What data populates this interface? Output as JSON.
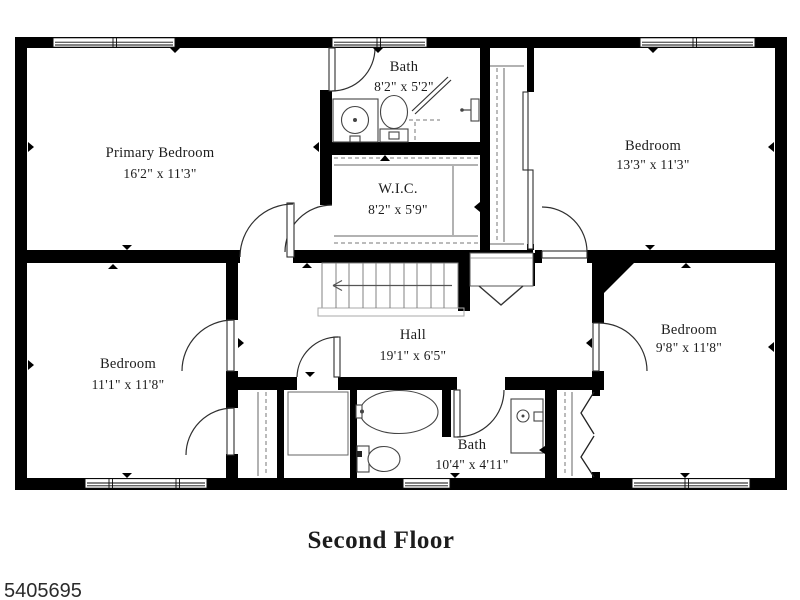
{
  "floor_plan": {
    "title": "Second Floor",
    "listing_id": "5405695",
    "background": "#ffffff",
    "wall_color": "#000000",
    "fixture_line_color": "#4a4a4a",
    "text_color": "#1c1c1c",
    "rooms": [
      {
        "name": "Primary Bedroom",
        "dims": "16'2\" x 11'3\""
      },
      {
        "name": "Bath",
        "dims": "8'2\" x 5'2\""
      },
      {
        "name": "W.I.C.",
        "dims": "8'2\" x 5'9\""
      },
      {
        "name": "Bedroom",
        "dims": "13'3\" x 11'3\""
      },
      {
        "name": "Hall",
        "dims": "19'1\" x 6'5\""
      },
      {
        "name": "Bedroom",
        "dims": "11'1\" x 11'8\""
      },
      {
        "name": "Bath",
        "dims": "10'4\" x 4'11\""
      },
      {
        "name": "Bedroom",
        "dims": "9'8\" x 11'8\""
      }
    ]
  }
}
